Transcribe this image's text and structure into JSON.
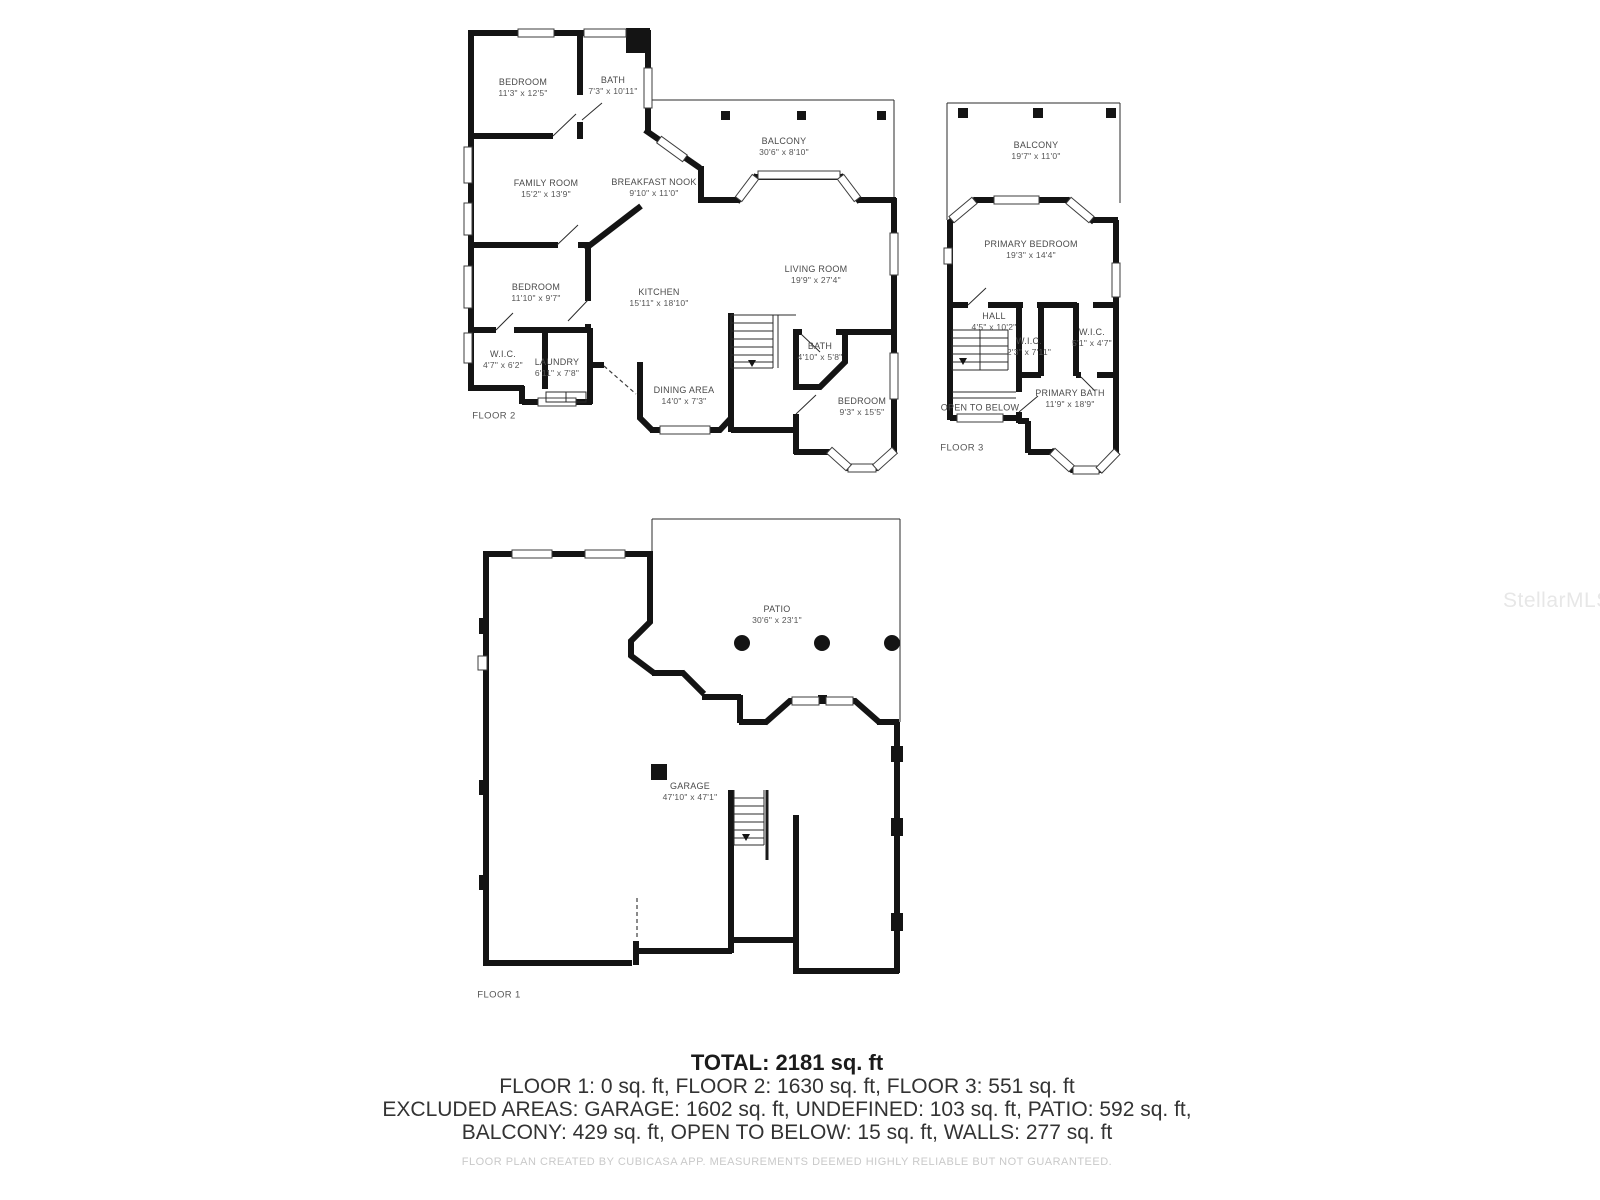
{
  "watermark": "StellarMLS",
  "floor2": {
    "label": "FLOOR 2",
    "rooms": [
      {
        "name": "BEDROOM",
        "dims": "11'3\" x 12'5\""
      },
      {
        "name": "BATH",
        "dims": "7'3\" x 10'11\""
      },
      {
        "name": "BALCONY",
        "dims": "30'6\" x 8'10\""
      },
      {
        "name": "FAMILY ROOM",
        "dims": "15'2\" x 13'9\""
      },
      {
        "name": "BREAKFAST NOOK",
        "dims": "9'10\" x 11'0\""
      },
      {
        "name": "BEDROOM",
        "dims": "11'10\" x 9'7\""
      },
      {
        "name": "KITCHEN",
        "dims": "15'11\" x 18'10\""
      },
      {
        "name": "LIVING ROOM",
        "dims": "19'9\" x 27'4\""
      },
      {
        "name": "W.I.C.",
        "dims": "4'7\" x 6'2\""
      },
      {
        "name": "LAUNDRY",
        "dims": "6'11\" x 7'8\""
      },
      {
        "name": "DINING AREA",
        "dims": "14'0\" x 7'3\""
      },
      {
        "name": "BATH",
        "dims": "4'10\" x 5'8\""
      },
      {
        "name": "BEDROOM",
        "dims": "9'3\" x 15'5\""
      }
    ]
  },
  "floor3": {
    "label": "FLOOR 3",
    "rooms": [
      {
        "name": "BALCONY",
        "dims": "19'7\" x 11'0\""
      },
      {
        "name": "PRIMARY BEDROOM",
        "dims": "19'3\" x 14'4\""
      },
      {
        "name": "HALL",
        "dims": "4'5\" x 10'2\""
      },
      {
        "name": "W.I.C.",
        "dims": "2'3\" x 7'11\""
      },
      {
        "name": "W.I.C.",
        "dims": "5'1\" x 4'7\""
      },
      {
        "name": "PRIMARY BATH",
        "dims": "11'9\" x 18'9\""
      },
      {
        "name": "OPEN TO BELOW",
        "dims": ""
      }
    ]
  },
  "floor1": {
    "label": "FLOOR 1",
    "rooms": [
      {
        "name": "PATIO",
        "dims": "30'6\" x 23'1\""
      },
      {
        "name": "GARAGE",
        "dims": "47'10\" x 47'1\""
      }
    ]
  },
  "summary": {
    "total": "TOTAL: 2181 sq. ft",
    "floors_line": "FLOOR 1: 0 sq. ft, FLOOR 2: 1630 sq. ft, FLOOR 3: 551 sq. ft",
    "excluded_line1": "EXCLUDED AREAS: GARAGE: 1602 sq. ft, UNDEFINED: 103 sq. ft, PATIO: 592 sq. ft,",
    "excluded_line2": "BALCONY: 429 sq. ft, OPEN TO BELOW: 15 sq. ft, WALLS: 277 sq. ft"
  },
  "footer": "FLOOR PLAN CREATED BY CUBICASA APP. MEASUREMENTS DEEMED HIGHLY RELIABLE BUT NOT GUARANTEED."
}
